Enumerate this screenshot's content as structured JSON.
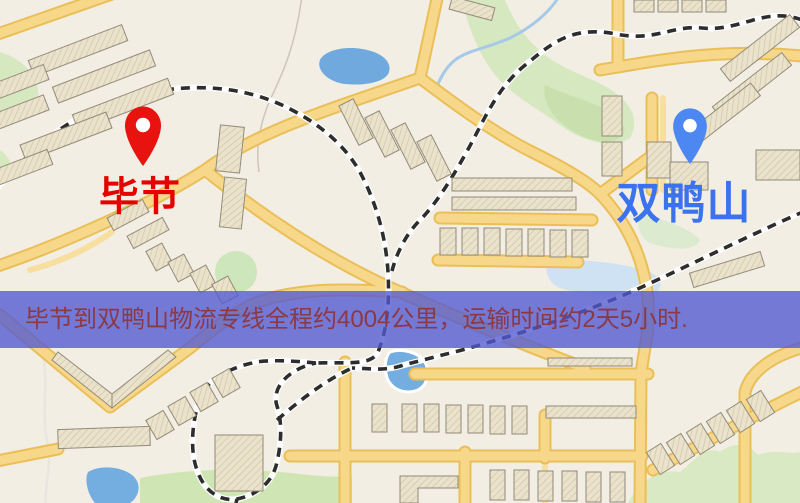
{
  "map": {
    "origin": {
      "name": "毕节"
    },
    "destination": {
      "name": "双鸭山"
    },
    "info_banner": {
      "text": "毕节到双鸭山物流专线全程约4004公里，运输时间约2天5小时."
    }
  },
  "colors": {
    "origin_marker": "#e8120e",
    "origin_label": "#e60000",
    "destination_marker": "#4d87f2",
    "destination_label": "#3b72ee",
    "banner_background": "rgba(82,88,210,0.78)",
    "banner_text": "#8a3946",
    "map_background": "#f2eee3",
    "road_fill": "#f7d88a",
    "road_casing": "#eabf58",
    "minor_road": "#f8dfa0",
    "park_green": "#d6e8c0",
    "water_blue": "#6fa9dd",
    "railway_black": "#2d2d2d",
    "building_outline": "#938b7a"
  }
}
